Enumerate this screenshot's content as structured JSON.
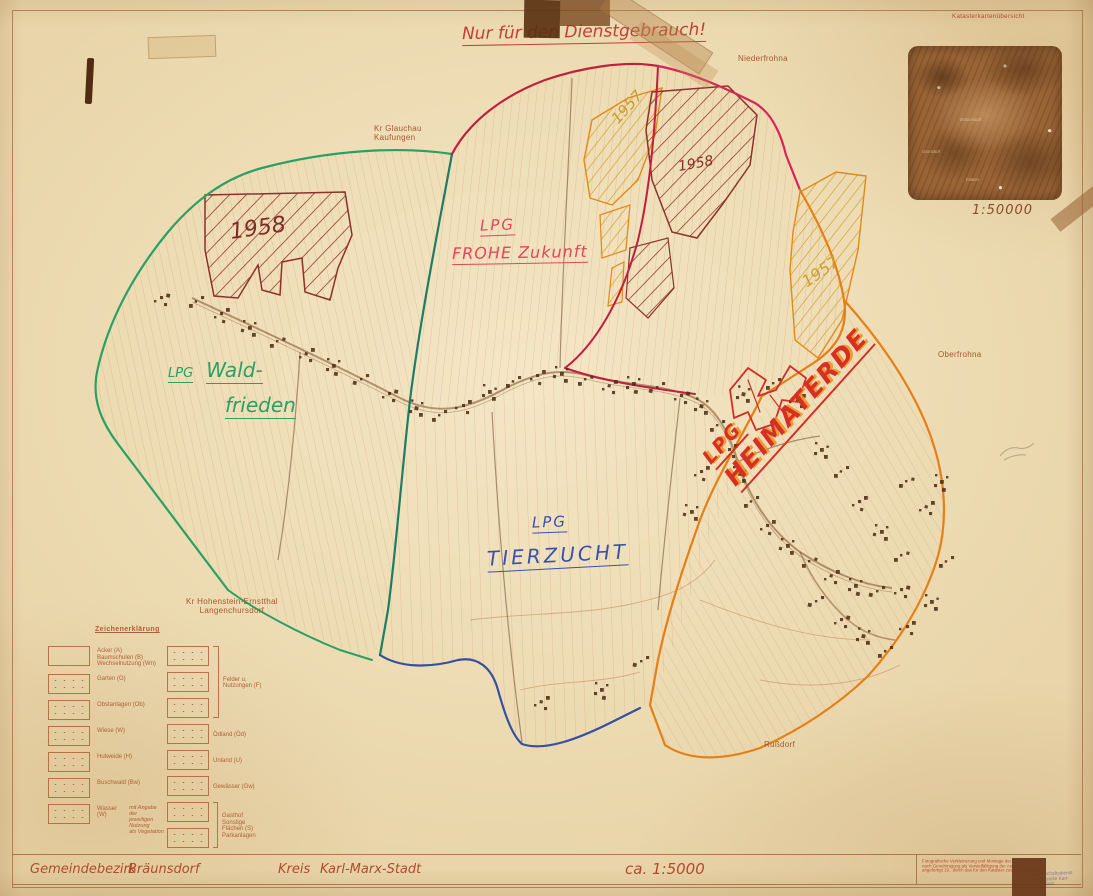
{
  "header": {
    "classification_notice": "Nur für den Dienstgebrauch!",
    "inset": {
      "title": "Katasterkartenübersicht",
      "scale": "1:50000",
      "labels": {
        "center": "Bräunsdorf",
        "left": "chursdorf",
        "bottom": "Falken"
      }
    }
  },
  "annotations": {
    "waldfrieden_prefix": "LPG",
    "waldfrieden_name1": "Wald-",
    "waldfrieden_name2": "frieden",
    "frohe_zukunft_line1": "LPG",
    "frohe_zukunft_line2": "FROHE Zukunft",
    "tierzucht_line1": "LPG",
    "tierzucht_line2": "TIERZUCHT",
    "heimaterde_line1": "LPG",
    "heimaterde_line2": "HEIMATERDE",
    "year_nw": "1958",
    "year_top_yellow": "1957",
    "year_top_red": "1958",
    "year_east": "1957"
  },
  "place_names": {
    "kr_glauchau": "Kr Glauchau\nKaufungen",
    "niederfrohna": "Niederfrohna",
    "oberfrohna": "Oberfrohna",
    "kr_hohenstein": "Kr Hohenstein-Ernstthal\nLangenchursdorf",
    "russdorf": "Rußdorf"
  },
  "legend": {
    "title": "Zeichenerklärung",
    "left": [
      {
        "label": "Acker (A)\nBaumschulen (B)\nWechselnutzung (Wn)"
      },
      {
        "label": "Garten (G)"
      },
      {
        "label": "Obstanlagen (Ob)"
      },
      {
        "label": "Wiese (W)"
      },
      {
        "label": "Hutweide (H)"
      },
      {
        "label": "Buschwald (Bw)"
      },
      {
        "label": "Wasser (W)",
        "note": "mit Angabe der\njeweiligen Nutzung\nals Vegetation"
      }
    ],
    "right": [
      {
        "label": "Felder u.\nNutzungen (F)",
        "boxes": 3
      },
      {
        "label": "Ödland (Öd)",
        "boxes": 1
      },
      {
        "label": "Unland (U)",
        "boxes": 1
      },
      {
        "label": "Gewässer (Gw)",
        "boxes": 1
      },
      {
        "label": "Gasthof\nSonstige Flächen (S)\nParkanlagen",
        "boxes": 2
      }
    ]
  },
  "footer": {
    "district_label": "Gemeindebezirk",
    "district_value": "Bräunsdorf",
    "kreis_label": "Kreis",
    "kreis_value": "Karl-Marx-Stadt",
    "scale": "ca. 1:5000",
    "fineprint": "Fotografische Verkleinerung und Montage der Katasterkarten\nnach Genehmigung als Vervielfältigung der Anzeige\nangefertigt 19.. durch das für den Kataster zuständige Amt",
    "stamp_text": "Liegenschaftsdienst\nBezirksstelle Karl-Marx-Stadt"
  },
  "colors": {
    "paper": "#e9d5a9",
    "frame": "#a5683c",
    "green_boundary": "#2aa163",
    "teal_boundary": "#1f7d63",
    "blue_boundary": "#3550a0",
    "crimson_boundary": "#c21f3f",
    "magenta_boundary": "#d92556",
    "orange_boundary": "#e67f17",
    "red_hatch": "#8e312b",
    "yellow_hatch": "#d2a22e",
    "handwriting_red": "#d8404f",
    "handwriting_green": "#2aa163",
    "handwriting_blue": "#3a50b0",
    "heimaterde_red": "#d63024",
    "heimaterde_orange": "#f09020",
    "print_brown": "#a5582f"
  }
}
